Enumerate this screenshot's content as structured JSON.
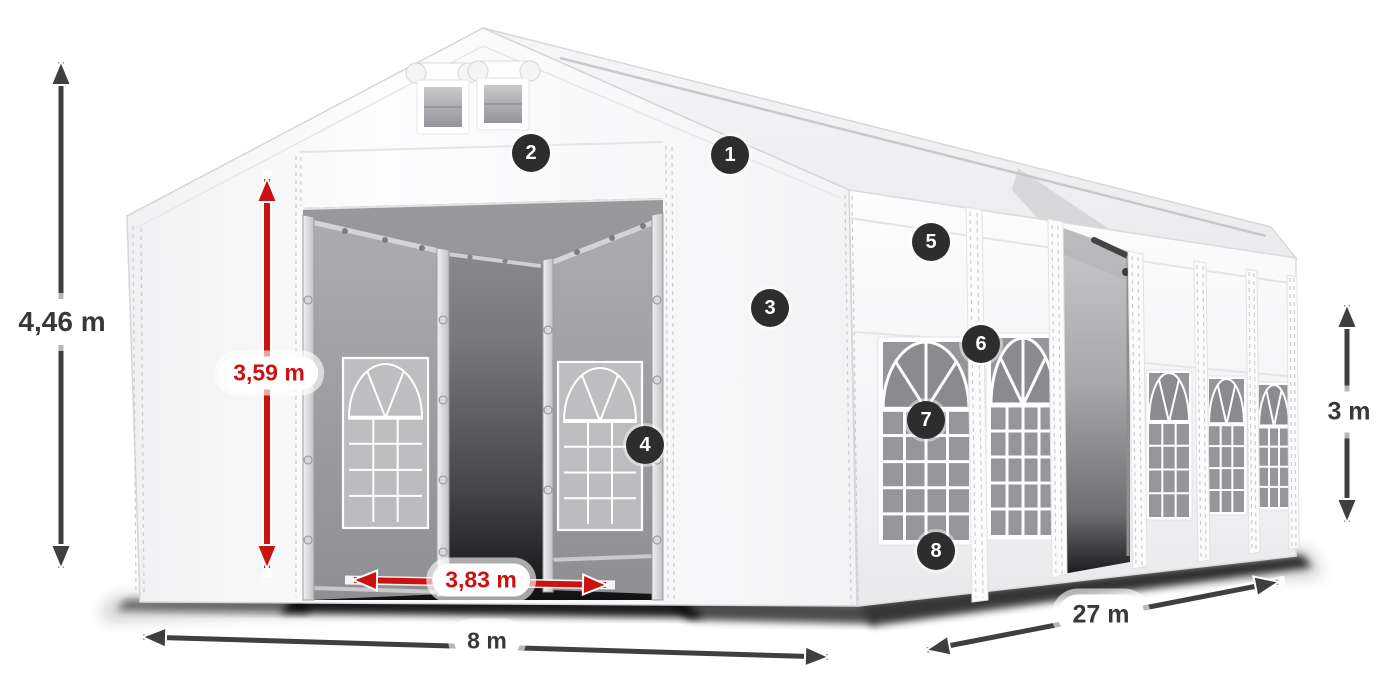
{
  "diagram": {
    "type": "tent-dimension-diagram",
    "dimensions": {
      "total_height": "4,46 m",
      "entrance_height": "3,59 m",
      "entrance_width": "3,83 m",
      "width": "8 m",
      "length": "27 m",
      "side_height": "3 m"
    },
    "badges": [
      "1",
      "2",
      "3",
      "4",
      "5",
      "6",
      "7",
      "8"
    ],
    "colors": {
      "accent_red": "#cc1111",
      "arrow_gray": "#3f3f42",
      "badge_bg": "#2d2d2e",
      "tent_white": "#f7f7f9"
    }
  }
}
